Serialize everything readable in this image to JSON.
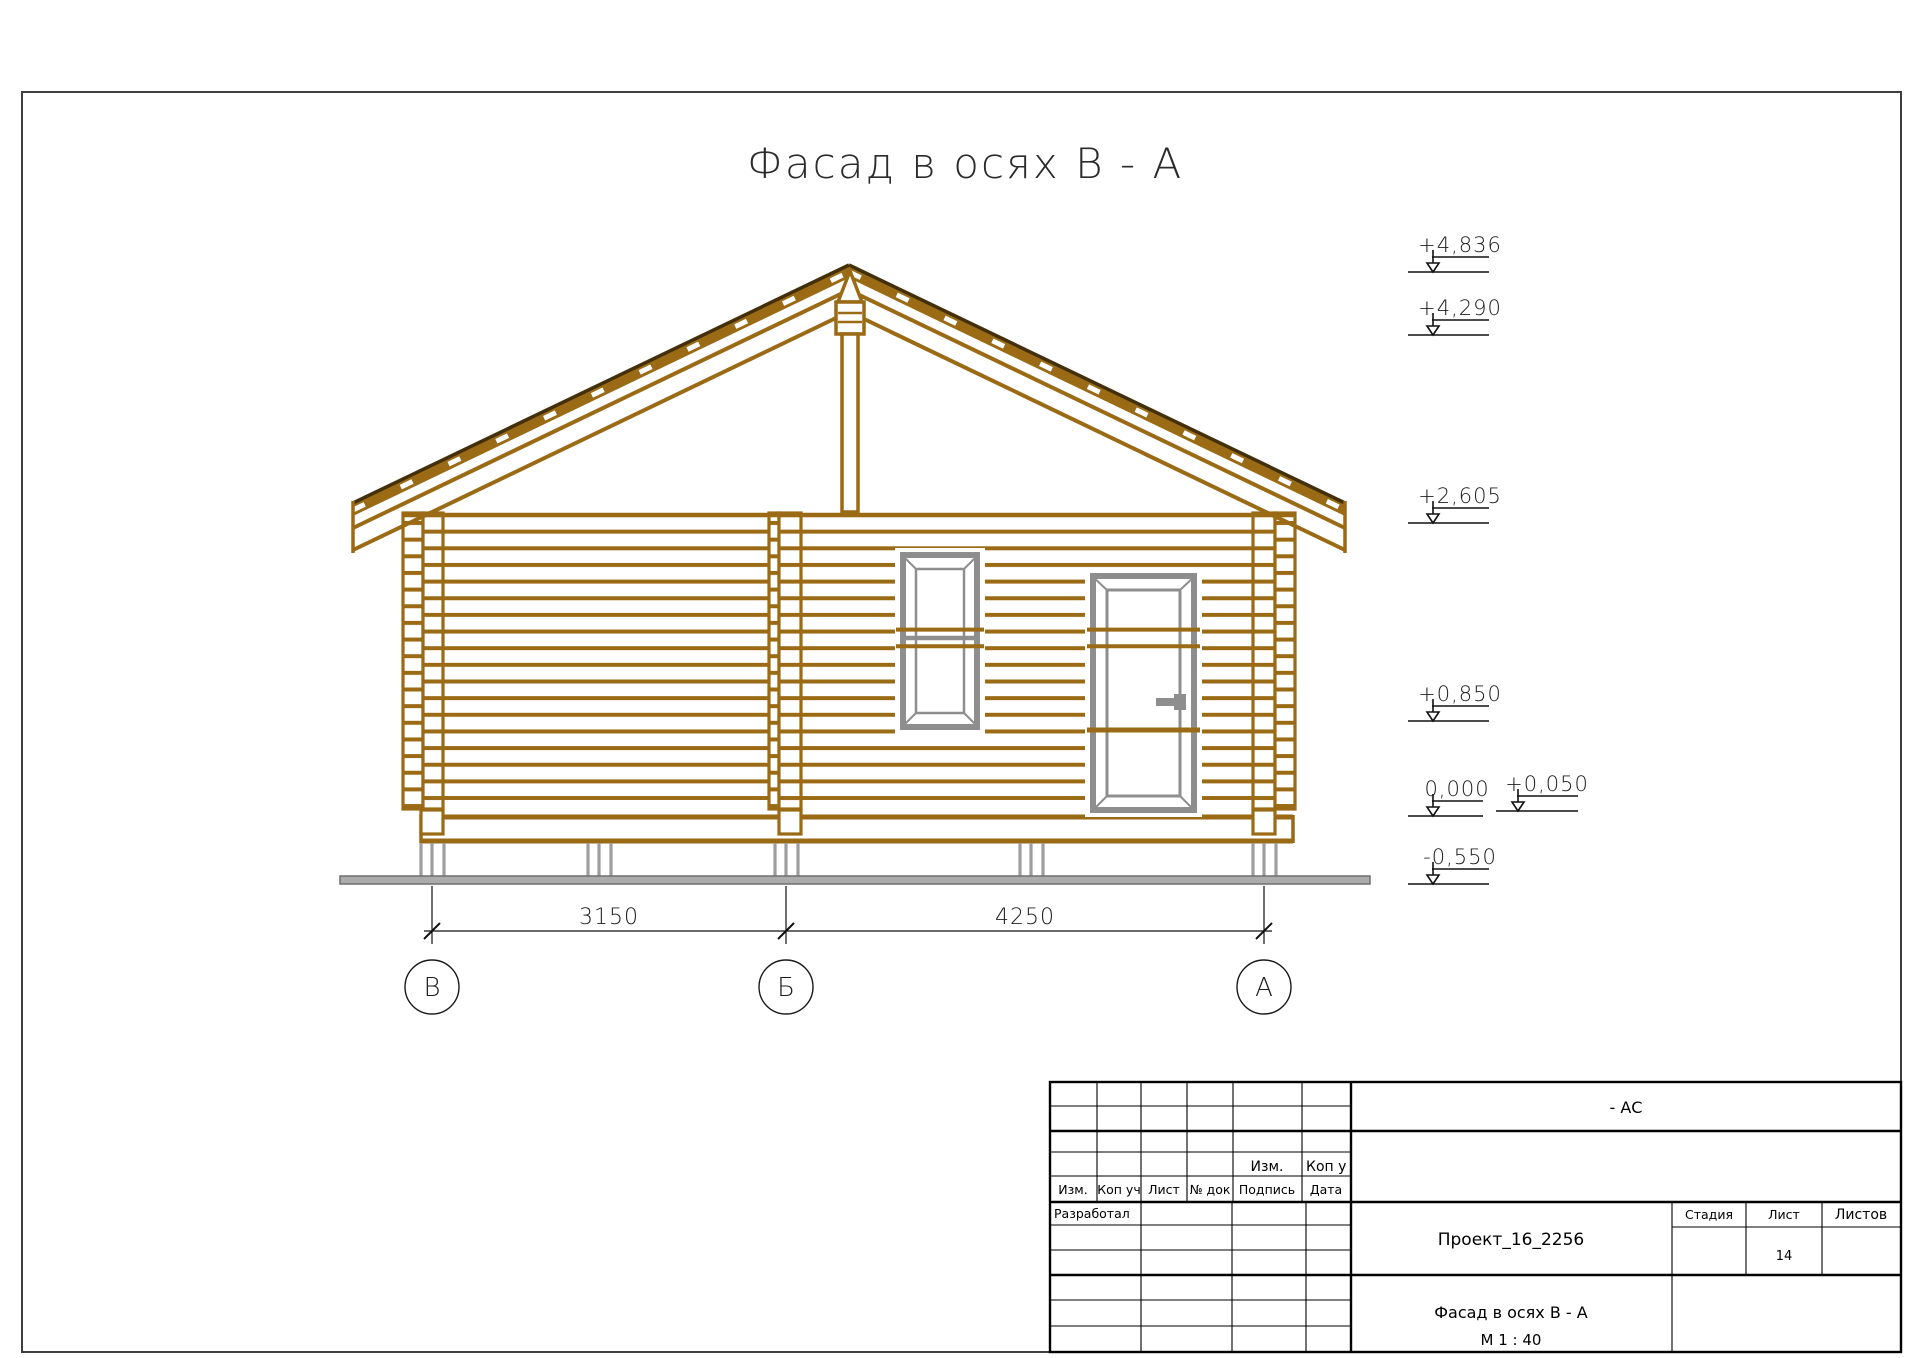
{
  "sheet": {
    "title": "Фасад в осях В - А"
  },
  "elevations": [
    {
      "value": "+4,836"
    },
    {
      "value": "+4,290"
    },
    {
      "value": "+2,605"
    },
    {
      "value": "+0,850"
    },
    {
      "value": "0,000"
    },
    {
      "value": "+0,050"
    },
    {
      "value": "-0,550"
    }
  ],
  "dimensions": [
    {
      "value": "3150"
    },
    {
      "value": "4250"
    }
  ],
  "axes": [
    {
      "label": "В"
    },
    {
      "label": "Б"
    },
    {
      "label": "А"
    }
  ],
  "colors": {
    "log_brown": "#9A6A15",
    "roof_dark": "#43300A",
    "joinery_gray": "#8E8E8E",
    "ground_gray": "#ACACAC"
  },
  "title_block": {
    "doc_code": "- АС",
    "project": "Проект_16_2256",
    "drawing_title": "Фасад в осях В - А",
    "scale": "М 1 : 40",
    "sheet_number": "14",
    "upper_row": {
      "izm": "Изм.",
      "kop": "Коп у"
    },
    "header_row": {
      "izm": "Изм.",
      "kop_uch": "Коп уч",
      "list": "Лист",
      "no_dok": "№ док",
      "podpis": "Подпись",
      "data": "Дата"
    },
    "developed_label": "Разработал",
    "stage_label": "Стадия",
    "sheet_label": "Лист",
    "sheets_label": "Листов"
  }
}
